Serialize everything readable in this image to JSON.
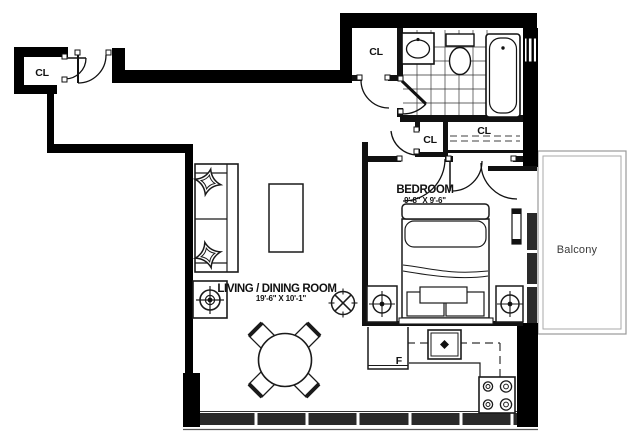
{
  "floorplan": {
    "rooms": {
      "living_dining": {
        "name": "LIVING / DINING ROOM",
        "dims": "19'-6\" X 10'-1\""
      },
      "bedroom": {
        "name": "BEDROOM",
        "dims": "9'-8\" X 9'-6\""
      },
      "balcony": {
        "name": "Balcony"
      }
    },
    "closets": {
      "entry": "CL",
      "hall": "CL",
      "bedroom_small": "CL",
      "bedroom_wide": "CL"
    },
    "appliances": {
      "fridge": "F"
    },
    "colors": {
      "walls": "#000000",
      "interior_walls": "#111111",
      "glazing_band": "#2a2a2a",
      "balcony_outline": "#999999"
    }
  }
}
